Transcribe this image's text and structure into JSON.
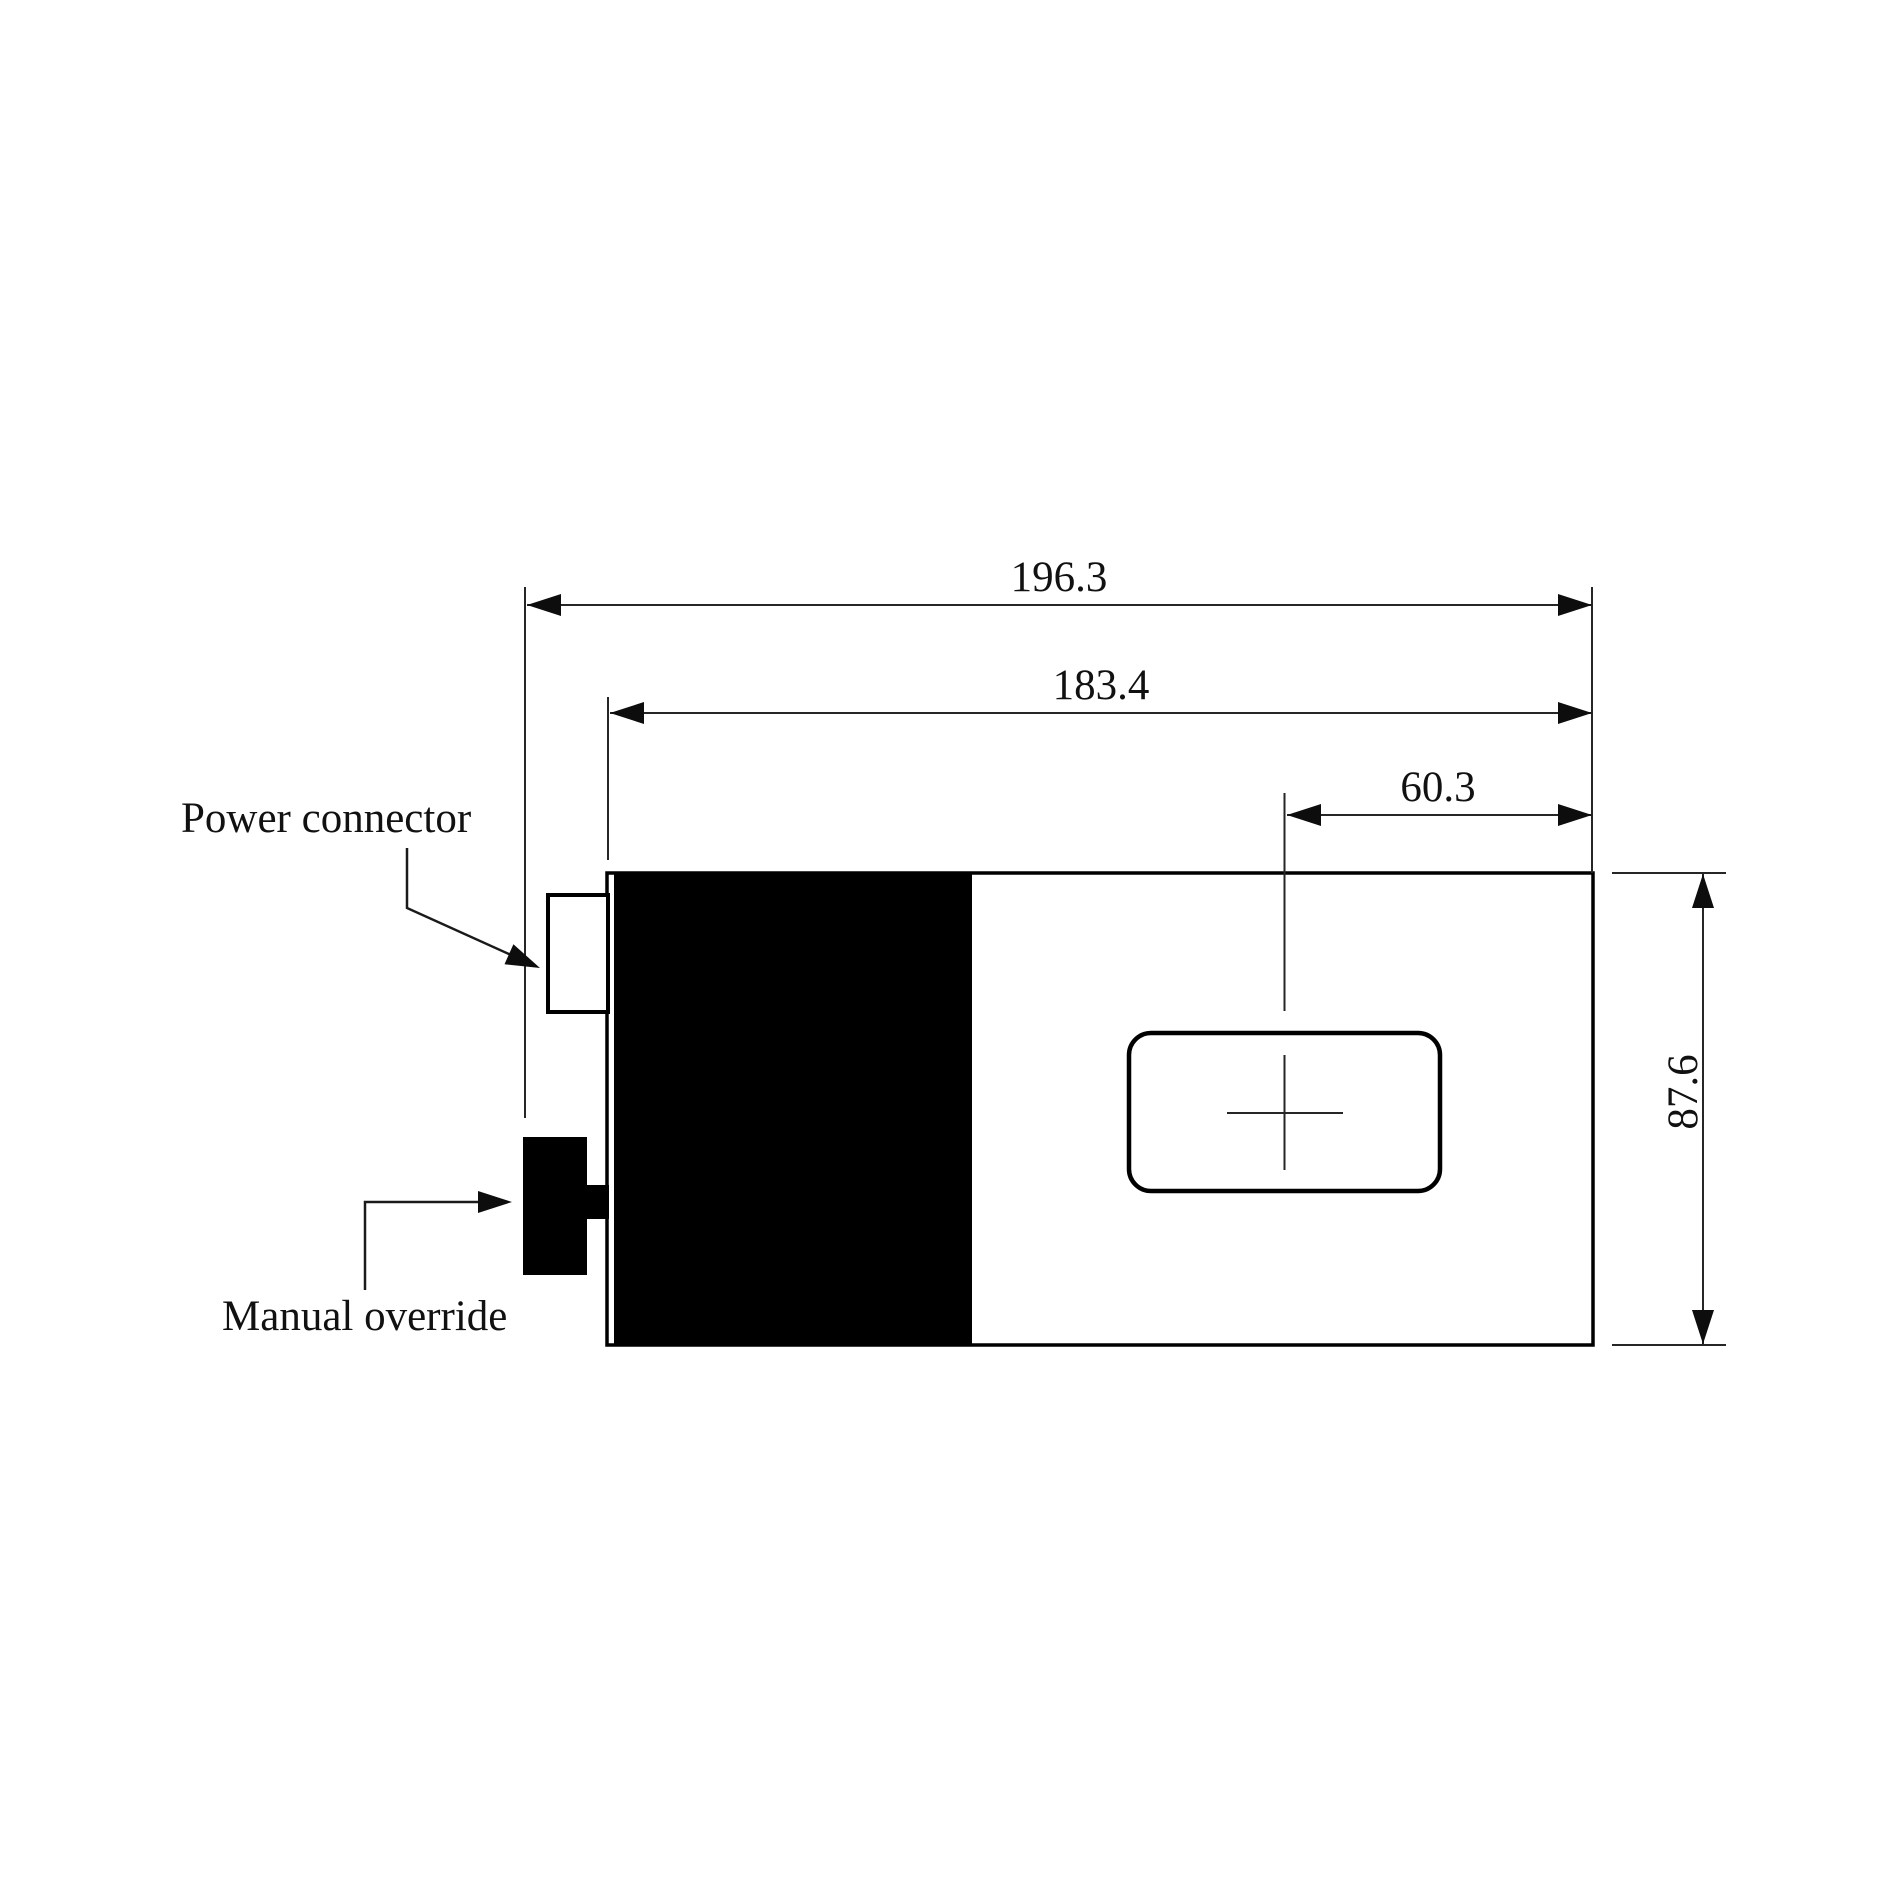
{
  "drawing": {
    "type": "technical-dimension-drawing",
    "labels": {
      "power_connector": "Power connector",
      "manual_override": "Manual override"
    },
    "dimensions": {
      "overall_length": "196.3",
      "body_length": "183.4",
      "cutout_offset": "60.3",
      "body_height": "87.6"
    },
    "colors": {
      "line": "#262626",
      "shape_fill": "#000000",
      "background": "#ffffff"
    }
  }
}
